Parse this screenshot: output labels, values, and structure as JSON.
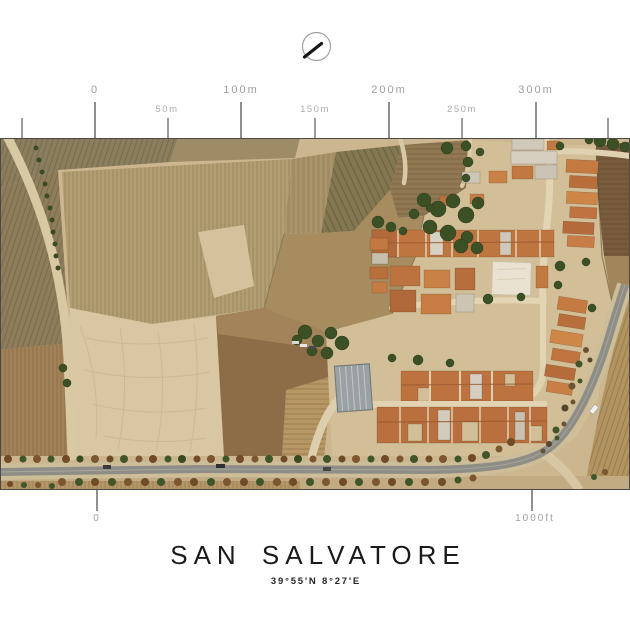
{
  "compass": {
    "icon": "north-arrow"
  },
  "top_scale": {
    "unit": "meters",
    "labels": [
      "0",
      "50m",
      "100m",
      "150m",
      "200m",
      "250m",
      "300m"
    ]
  },
  "bottom_scale": {
    "unit": "feet",
    "labels": [
      "0",
      "1000ft"
    ]
  },
  "title": {
    "text": "SAN SALVATORE",
    "coordinates": "39°55'N 8°27'E"
  },
  "colors": {
    "scale_label": "#9e9e9e",
    "tick": "#8d8d8d",
    "title_text": "#1b1b1b",
    "field_tan": "#b29e73",
    "field_pale": "#d8c7a2",
    "roof_terracotta": "#c0763f",
    "tree_green": "#3c5026",
    "road_asphalt": "#8e8e87"
  }
}
